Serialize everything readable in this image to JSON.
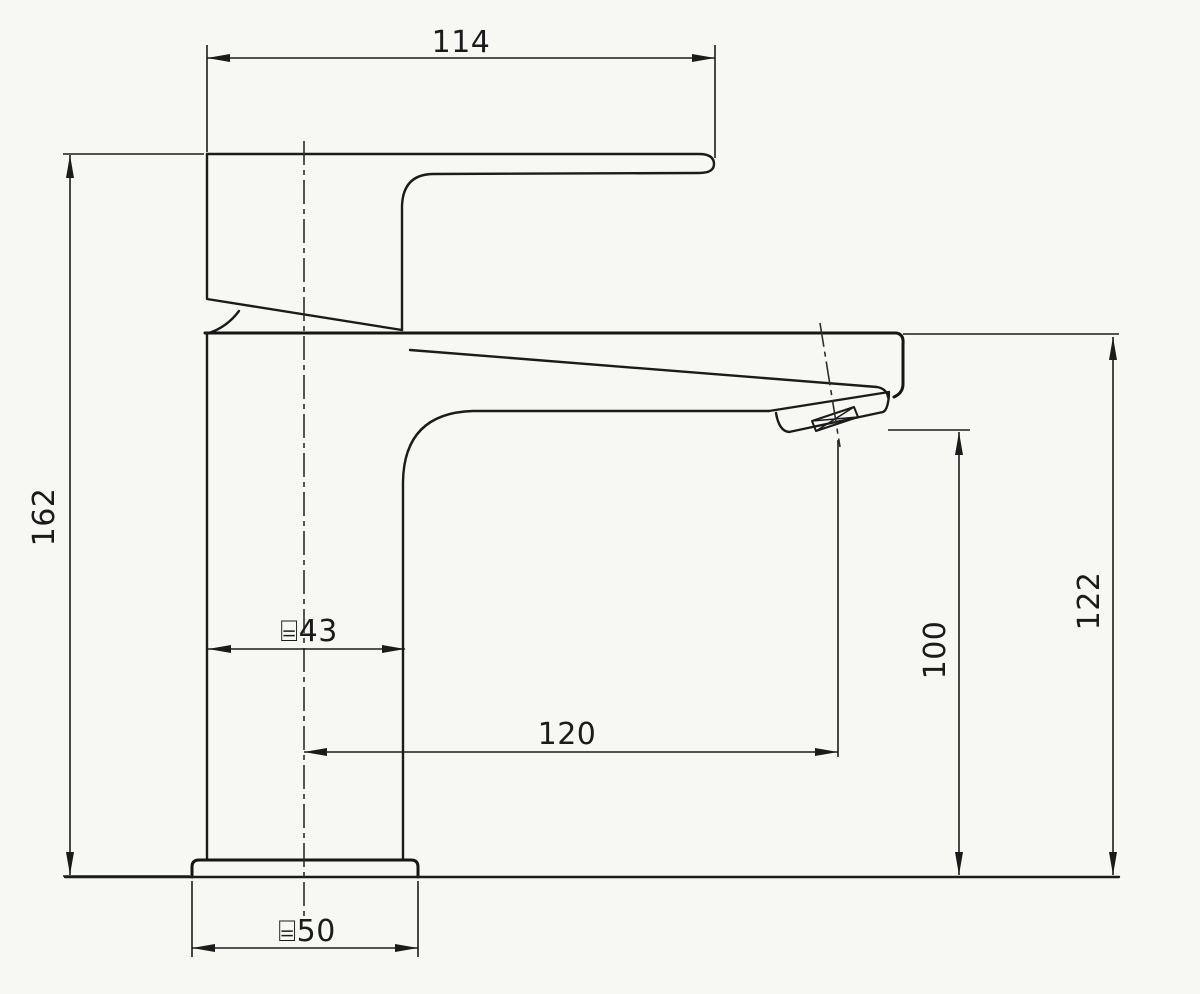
{
  "dimensions": {
    "handle_length": "114",
    "overall_height": "162",
    "body_diameter": "⌸43",
    "spout_reach": "120",
    "spout_outlet_height": "100",
    "spout_top_height": "122",
    "base_diameter": "⌸50"
  }
}
